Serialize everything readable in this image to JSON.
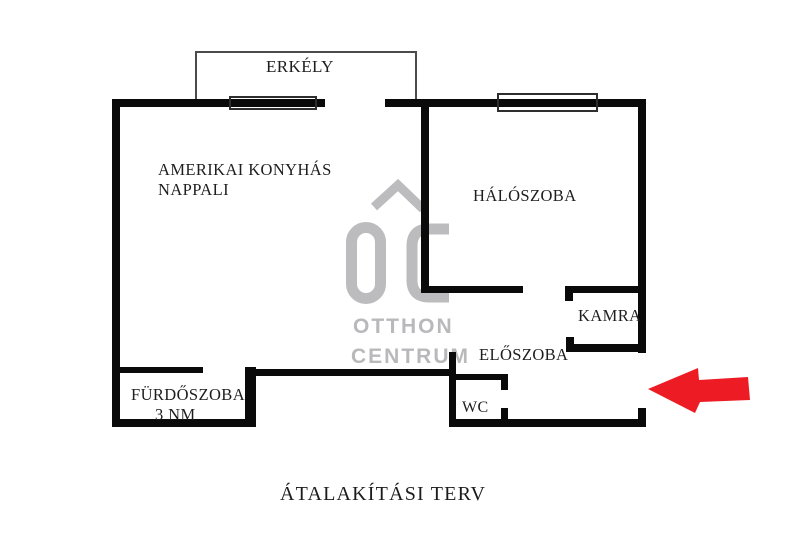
{
  "page": {
    "background": "#ffffff",
    "title": "ÁTALAKÍTÁSI TERV"
  },
  "floor_plan": {
    "rooms": {
      "balcony": {
        "label": "ERKÉLY"
      },
      "living_room": {
        "label_line1": "AMERIKAI KONYHÁS",
        "label_line2": "NAPPALI"
      },
      "bedroom": {
        "label": "HÁLÓSZOBA"
      },
      "pantry": {
        "label": "KAMRA"
      },
      "hallway": {
        "label": "ELŐSZOBA"
      },
      "bathroom": {
        "label": "FÜRDŐSZOBA",
        "area": "3 NM"
      },
      "wc": {
        "label": "WC"
      }
    },
    "entrance_arrow": {
      "direction": "left",
      "color": "#ed1c24"
    },
    "colors": {
      "walls": "#0a0a0a",
      "thin_lines": "#4b4b4b",
      "window_frames": "#2e2e2e",
      "watermark": "#b9b9bc"
    }
  },
  "watermark": {
    "monogram": "OC",
    "line1": "OTTHON",
    "line2": "CENTRUM"
  }
}
